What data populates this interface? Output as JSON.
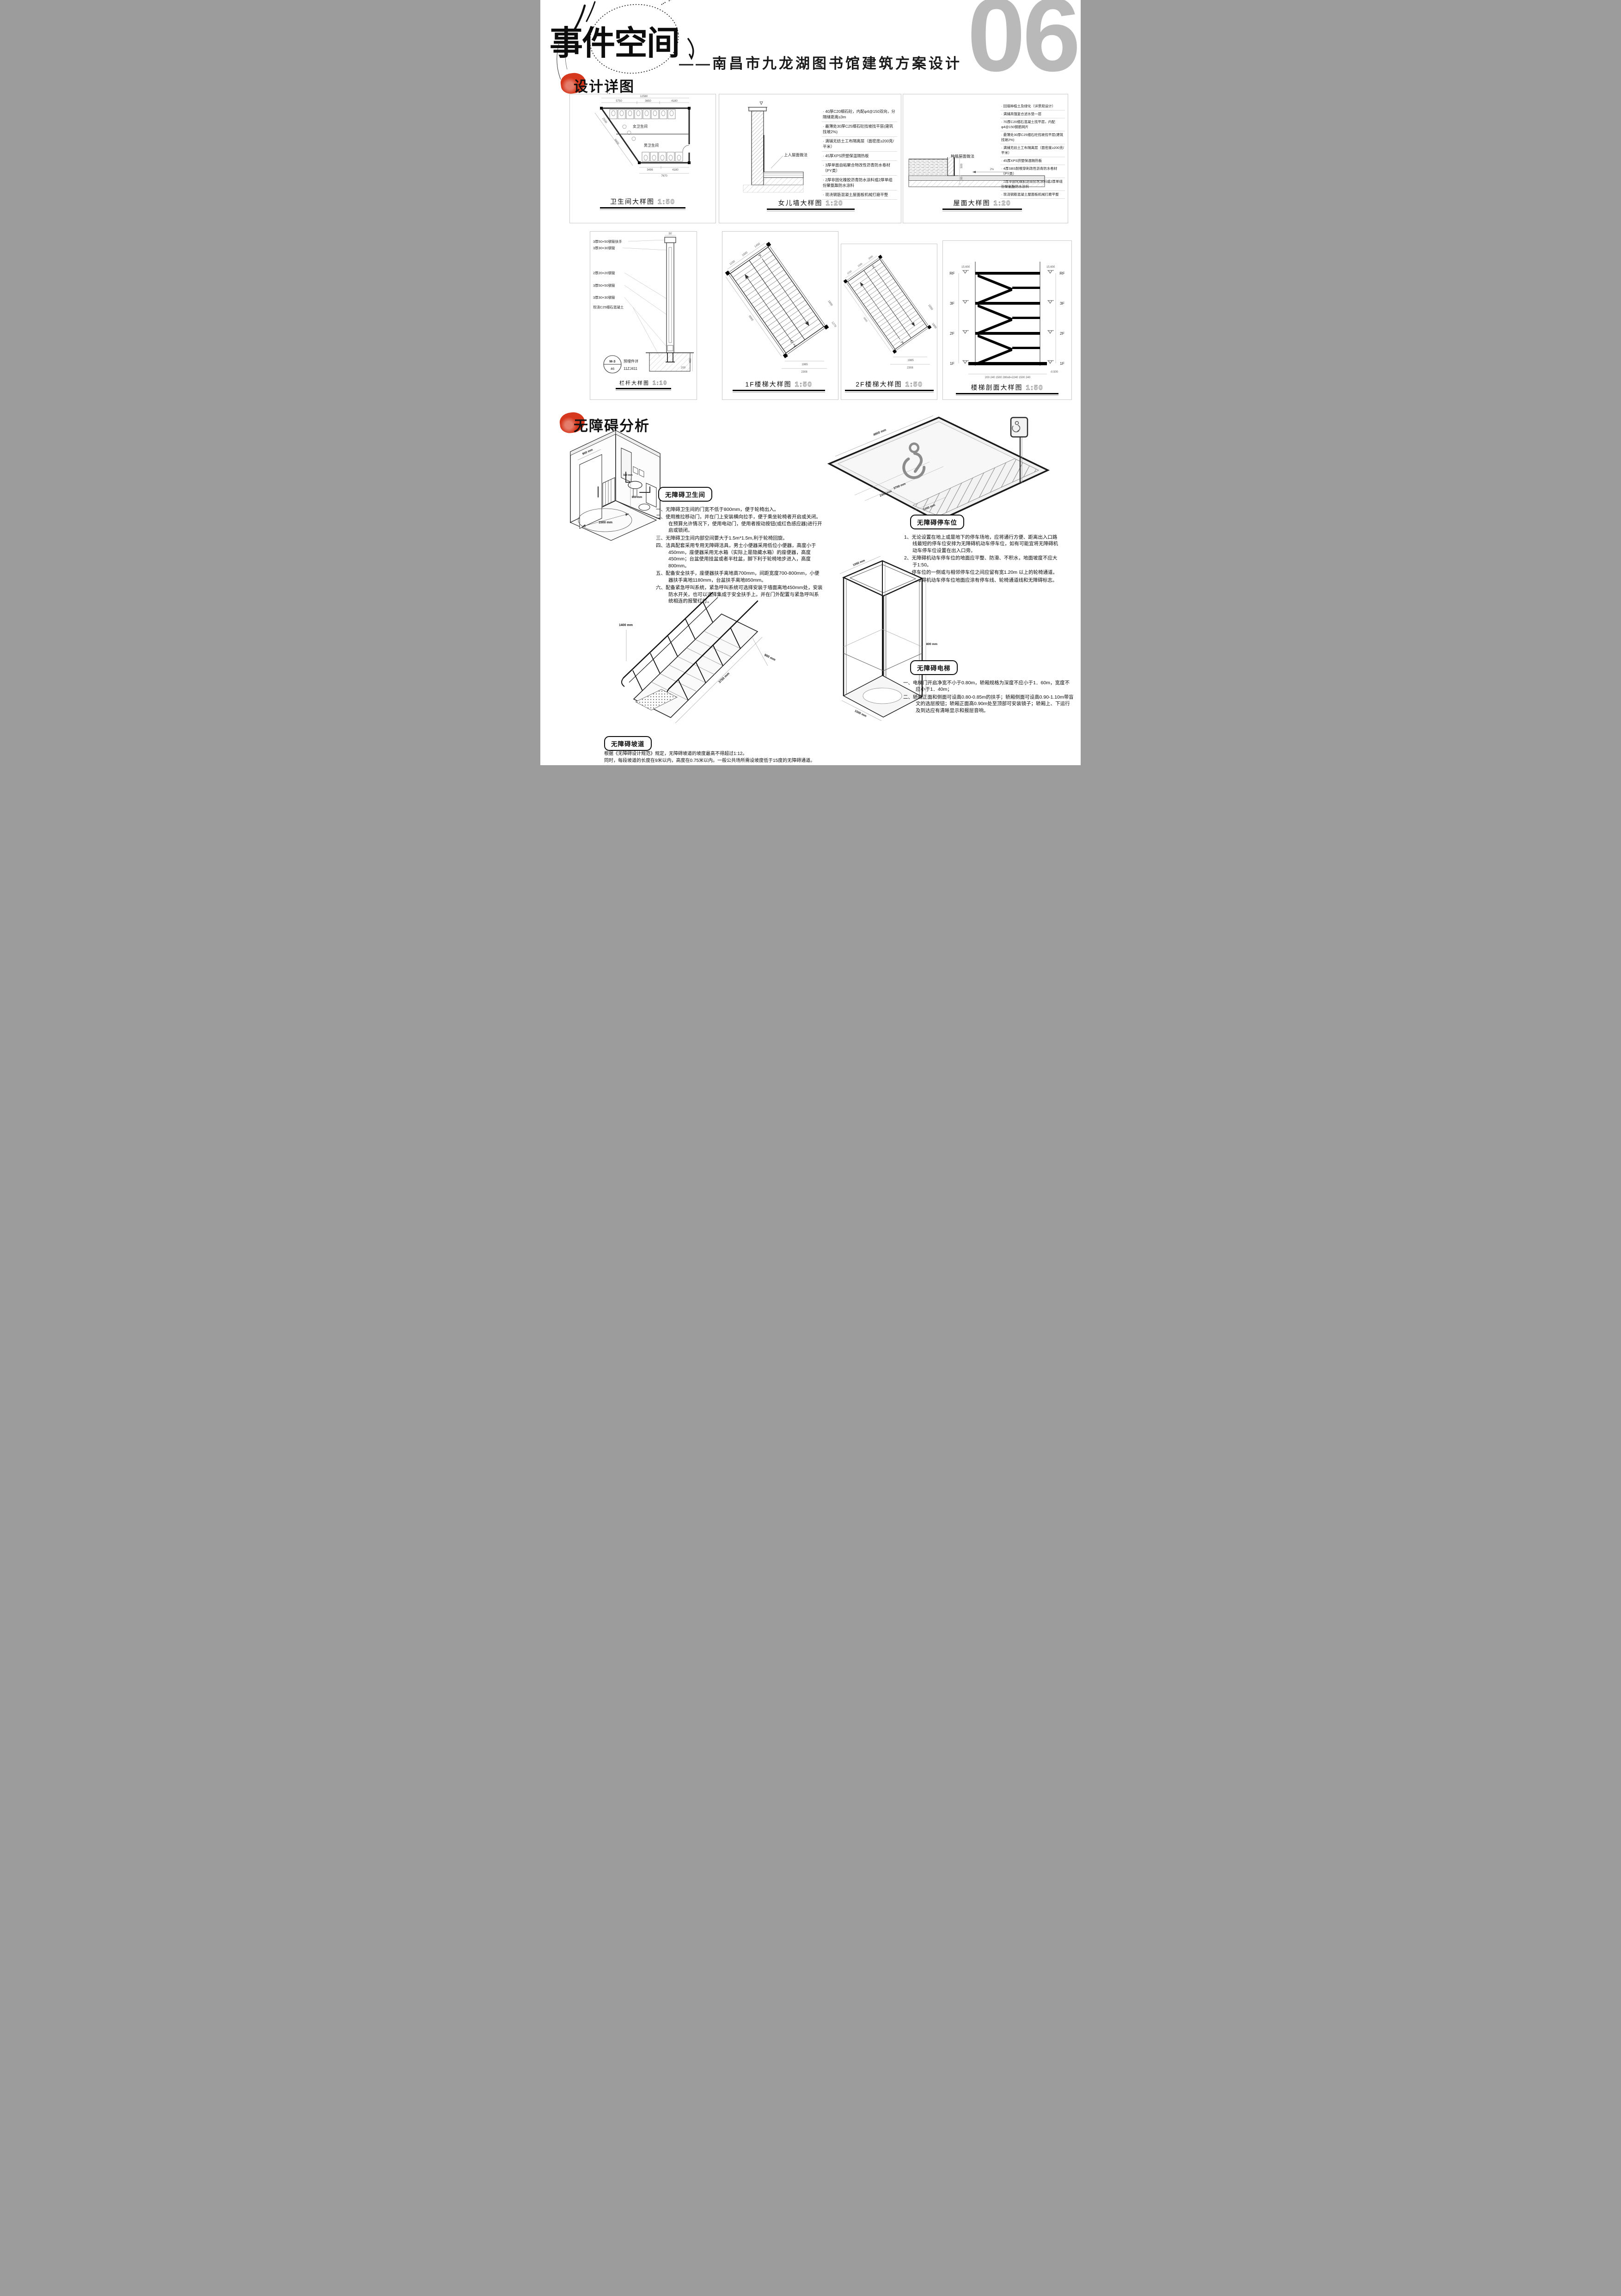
{
  "header": {
    "title": "事件空间",
    "subtitle": "——南昌市九龙湖图书馆建筑方案设计",
    "page_number": "06"
  },
  "sections": {
    "details_label": "设计详图",
    "accessibility_label": "无障碍分析"
  },
  "panels": {
    "toilet_plan": {
      "title": "卫生间大样图",
      "scale": "1:50",
      "labels": {
        "female": "女卫生间",
        "male": "男卫生间"
      },
      "dims": {
        "total_top": "12580",
        "seg1": "5750",
        "seg2": "3650",
        "seg3": "4180",
        "bottom1": "3496",
        "bottom2": "4180",
        "total_bottom": "7670",
        "diag1": "2930",
        "diag2": "9400"
      }
    },
    "parapet": {
      "title": "女儿墙大样图",
      "scale": "1:20",
      "layer_label": "上人屋面做法",
      "notes": [
        "40厚C20细石砼，内配φ4@150双向，分隔缝距离≤3m",
        "最薄处30厚C25细石砼找坡找平层(建筑找坡2%)",
        "满铺无纺土工布隔离层（面密度≥200克/平米）",
        "45厚XPS挤塑保温隔热板",
        "3厚单面自粘聚合物改性沥青防水卷材（PY类）",
        "2厚非固化橡胶沥青防水涂料或2厚单组份聚氨酯防水涂料",
        "现浇钢筋混凝土屋面板机械打磨平整"
      ]
    },
    "roof": {
      "title": "屋面大样图",
      "scale": "1:20",
      "layer_label": "种植屋面做法",
      "dims": {
        "d1": "100",
        "d2": "500",
        "d3": "190",
        "slope": "2%"
      },
      "notes": [
        "回填种植土及绿化（详景观设计）",
        "满铺高强复合滤水垫一层",
        "70厚C20细石混凝土找平层，内配φ4@150钢筋网片",
        "最薄处30厚C25细石砼找坡找平层(建筑找坡2%)",
        "满铺无纺土工布隔离层（面密度≥200克/平米）",
        "45厚XPS挤塑保温隔热板",
        "4厚SBS耐根穿刺改性沥青防水卷材（PY类）",
        "2厚非固化橡胶沥青防水涂料或2厚单组份聚氨酯防水涂料",
        "现浇钢筋混凝土屋面板机械打磨平整"
      ]
    },
    "railing": {
      "title": "栏杆大样图",
      "scale": "1:10",
      "annotations": [
        "3厚50×50钢管扶手",
        "3厚30×30钢管",
        "2厚20×20钢管",
        "3厚50×50钢管",
        "3厚30×30钢管",
        "现浇C25细石混凝土"
      ],
      "dims": {
        "top": "50",
        "embed": "450",
        "anchor": "200"
      },
      "tag": {
        "code": "M-3",
        "num": "46",
        "text1": "预埋件详",
        "text2": "11ZJ411"
      }
    },
    "stair_1f": {
      "title": "1F楼梯大样图",
      "scale": "1:50",
      "marks": {
        "up": "上",
        "down": "下"
      },
      "dims": {
        "t1": "1150",
        "t2": "1500",
        "t3": "1450",
        "side": "3400",
        "b1": "1985",
        "b2": "2308",
        "r1": "1800",
        "r2": "1270"
      }
    },
    "stair_2f": {
      "title": "2F楼梯大样图",
      "scale": "1:50",
      "marks": {
        "up": "上",
        "down": "下"
      },
      "dims": {
        "t1": "1150",
        "t2": "1500",
        "t3": "2000",
        "side": "3400",
        "b1": "1985",
        "b2": "2308",
        "r1": "1650",
        "r2": "1800"
      }
    },
    "stair_section": {
      "title": "楼梯剖面大样图",
      "scale": "1:50",
      "floors": [
        "RF",
        "3F",
        "2F",
        "1F"
      ],
      "elev_top": "15.600",
      "elev_bottom": "-0.500",
      "bottom_dims": "200 240  1500  280x8=2240  1500  240"
    }
  },
  "accessibility": {
    "toilet": {
      "label": "无障碍卫生间",
      "dims": {
        "door": "900 mm",
        "basin": "320 mm",
        "height": "800 mm",
        "circle": "1500 mm"
      },
      "items": [
        "一、无障碍卫生间的门宽不低于800mm，便于轮椅出入。",
        "二、使用推拉移动门，并在门上安装横向拉手，便于乘坐轮椅者开启或关闭。在预算允许情况下，使用电动门，使用者按动按钮(或红色感应器)进行开启或锁闭。",
        "三、无障碍卫生间内部空间要大于1.5m*1.5m,利于轮椅回旋。",
        "四、洁具配套采用专用无障碍洁具，男士小便器采用低位小便器，高度小于450mm，座便器采用无水箱（实际上是隐藏水箱）的座便器，高度450mm；台盆使用挂盆或者半柱盆，脚下利于轮椅地步进入，高度800mm。",
        "五、配备安全扶手，座便器扶手离地高700mm，间距宽度700-800mm，小便器扶手离地1180mm，台盆扶手离地850mm。",
        "六、配备紧急呼叫系统，紧急呼叫系统可选择安装于墙面离地450mm处，安装防水开关，也可以选择集成于安全扶手上。并在门外配置与紧急呼叫系统相连的报警红灯。"
      ]
    },
    "parking": {
      "label": "无障碍停车位",
      "dims": {
        "length": "4900 mm",
        "width": "3700 mm",
        "bay": "2400 mm",
        "aisle": "1000 mm"
      },
      "items": [
        "1、无论设置在地上或是地下的停车场地，应将通行方便、距离出入口路线最短的停车位安排为无障碍机动车停车位，如有可能宜将无障碍机动车停车位设置在出入口旁。",
        "2、无障碍机动车停车位的地面应平整、防滑、不积水，地面坡度不应大于1:50。",
        "3、停车位的一侧或与相邻停车位之间应留有宽1.20m 以上的轮椅通道。",
        "4、无障碍机动车停车位地面应涂有停车线、轮椅通道线和无障碍标志。"
      ]
    },
    "ramp": {
      "label": "无障碍坡道",
      "dims": {
        "rail": "1400 mm",
        "width": "900 mm",
        "length": "3750 mm"
      },
      "lines": [
        "根据《无障碍设计规范》规定，无障碍坡道的坡度最高不得超过1:12。",
        "同时，每段坡道的长度在9米以内，高度在0.75米以内。一般公共场所需设坡度低于15度的无障碍通道。"
      ]
    },
    "elevator": {
      "label": "无障碍电梯",
      "dims": {
        "depth": "1050 mm",
        "width": "800 mm",
        "front": "1500 mm"
      },
      "items": [
        "一、电梯门开启净宽不小于0.80m，轿厢规格为深度不应小于1．60m，宽度不应小于1．40m；",
        "二、轿厢正面和侧面可设高0.80-0.85m的扶手；轿厢侧面可设高0.90-1.10m带盲文的选层按钮；轿厢正面高0.90m处至顶部可安装镜子；轿厢上、下运行及到达应有清晰显示和报层音响。"
      ]
    }
  }
}
